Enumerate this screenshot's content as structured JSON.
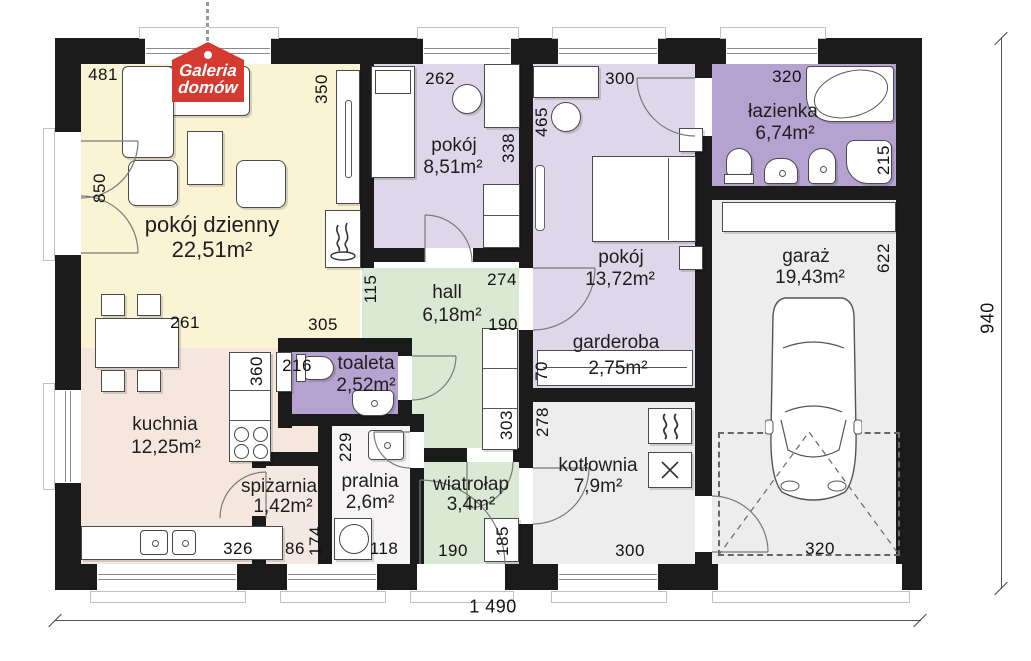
{
  "logo": {
    "line1": "Galeria",
    "line2": "domów"
  },
  "rooms": {
    "living": {
      "name": "pokój dzienny",
      "area": "22,51m²"
    },
    "room1": {
      "name": "pokój",
      "area": "8,51m²"
    },
    "room2": {
      "name": "pokój",
      "area": "13,72m²"
    },
    "bathroom": {
      "name": "łazienka",
      "area": "6,74m²"
    },
    "garage": {
      "name": "garaż",
      "area": "19,43m²"
    },
    "wardrobe": {
      "name": "garderoba",
      "area": "2,75m²"
    },
    "hall": {
      "name": "hall",
      "area": "6,18m²"
    },
    "toilet": {
      "name": "toaleta",
      "area": "2,52m²"
    },
    "kitchen": {
      "name": "kuchnia",
      "area": "12,25m²"
    },
    "pantry": {
      "name": "spiżarnia",
      "area": "1,42m²"
    },
    "laundry": {
      "name": "pralnia",
      "area": "2,6m²"
    },
    "vestibule": {
      "name": "wiatrołap",
      "area": "3,4m²"
    },
    "boiler": {
      "name": "kotłownia",
      "area": "7,9m²"
    }
  },
  "dims": {
    "d481": "481",
    "d850": "850",
    "d350": "350",
    "d262": "262",
    "d338": "338",
    "d300_top": "300",
    "d465": "465",
    "d320_bath": "320",
    "d215": "215",
    "d622": "622",
    "d261": "261",
    "d305": "305",
    "d115": "115",
    "d274": "274",
    "d190_hall": "190",
    "d303": "303",
    "d216": "216",
    "d360": "360",
    "d70": "70",
    "d278": "278",
    "d229": "229",
    "d174": "174",
    "d326": "326",
    "d86": "86",
    "d118": "118",
    "d190_entry": "190",
    "d185": "185",
    "d300_boiler": "300",
    "d320_garage": "320",
    "total_width": "1 490",
    "total_height": "940"
  },
  "icons": {
    "fireplace": "flame-icon",
    "heater": "heating-waves-icon",
    "furnace": "cross-icon",
    "logo_hanger": "chain-pin-icon"
  },
  "colors": {
    "wall": "#1b1b1b",
    "living": "#faf4d4",
    "kitchen": "#f5e7de",
    "bedroom": "#ddd7e9",
    "bathroom": "#b6a2d1",
    "hall_green": "#d9e9d4",
    "utility_grey": "#ededed",
    "logo_red": "#d43a30"
  }
}
